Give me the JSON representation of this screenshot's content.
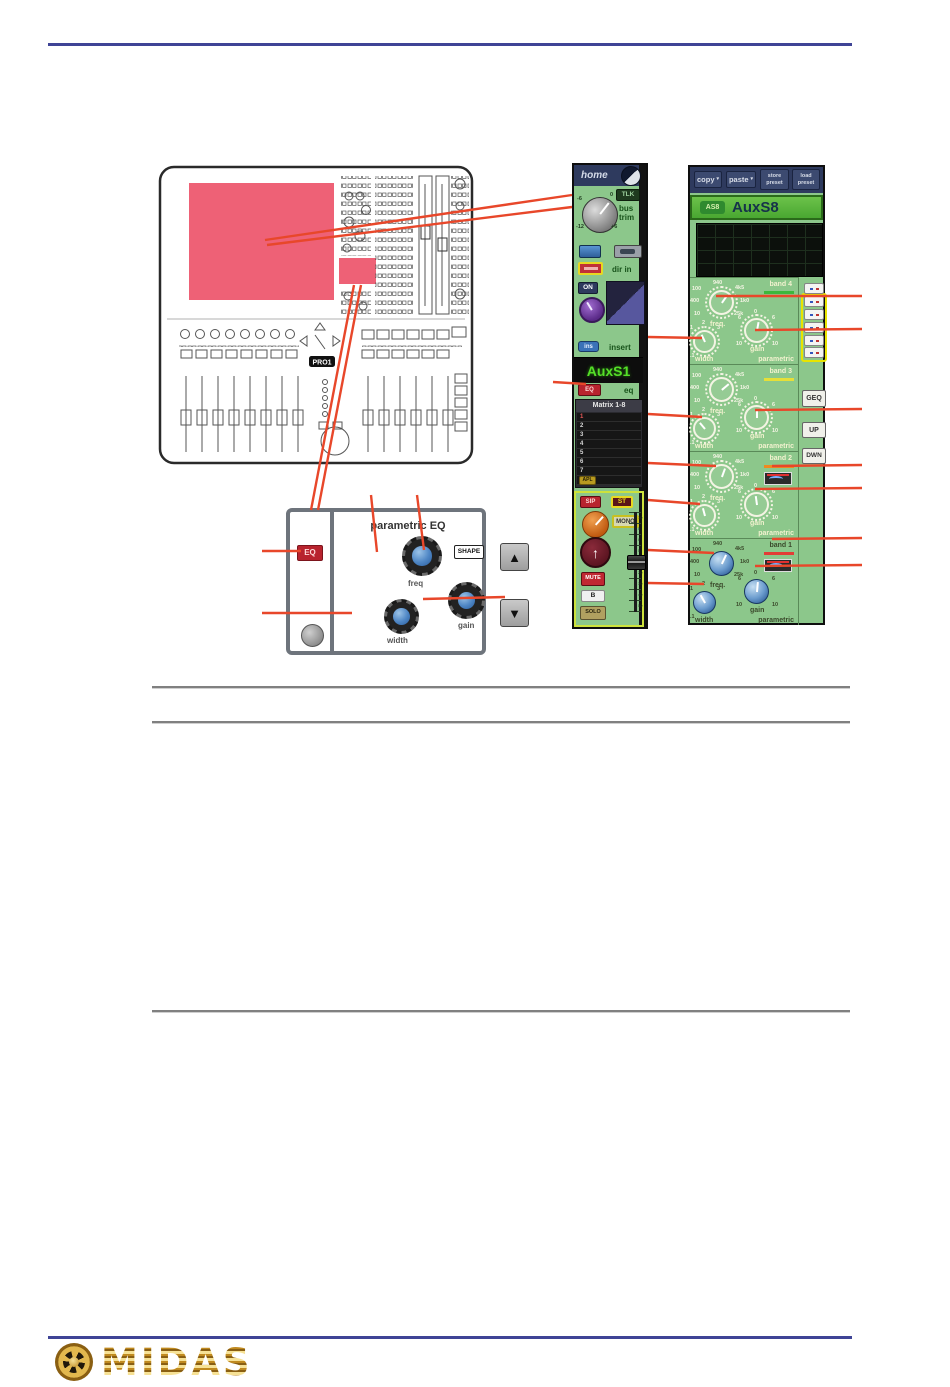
{
  "colors": {
    "accent_rule": "#3f4496",
    "callout": "#e8472a",
    "screen_highlight": "#ee6176",
    "strip_green": "#8cc78b",
    "name_text_green": "#55e028"
  },
  "console": {
    "model_badge": "PRO1"
  },
  "detail_panel": {
    "title": "parametric EQ",
    "eq_button": "EQ",
    "shape_button": "SHAPE",
    "freq_label": "freq",
    "width_label": "width",
    "gain_label": "gain",
    "up_icon": "▲",
    "down_icon": "▼"
  },
  "home_strip": {
    "header": "home",
    "tlk_button": "TLK",
    "bus_trim": {
      "line1": "bus",
      "line2": "trim",
      "tick_minus6": "-6",
      "tick_zero": "0",
      "tick_minus12": "-12",
      "tick_plus6": "+6"
    },
    "dir_in": {
      "label": "dir in"
    },
    "direct": {
      "on_button": "ON"
    },
    "insert": {
      "button": "ins",
      "label": "insert"
    },
    "name": "AuxS1",
    "eq": {
      "button": "EQ",
      "label": "eq"
    },
    "matrix": {
      "title": "Matrix 1-8",
      "rows": [
        "1",
        "2",
        "3",
        "4",
        "5",
        "6",
        "7",
        "8"
      ],
      "apl_button": "APL"
    },
    "master": {
      "sip": "SIP",
      "st": "ST",
      "mono": "MONO",
      "mute": "MUTE",
      "b": "B",
      "solo": "SOLO",
      "fader_ticks": [
        "10",
        "5",
        "0",
        "5",
        "10",
        "20",
        "30",
        "40",
        "50"
      ]
    }
  },
  "aux_strip": {
    "toolbar": {
      "copy": "copy",
      "paste": "paste",
      "store": "store preset",
      "load": "load preset",
      "dropdown_icon": "▾"
    },
    "name_badge": "AS8",
    "name": "AuxS8",
    "labels": {
      "freq": "freq.",
      "width": "width",
      "gain": "gain",
      "parametric": "parametric"
    },
    "freq_ticks": [
      "100",
      "940",
      "4k5",
      "400",
      "10",
      "1k0",
      "25k"
    ],
    "width_ticks": [
      "1",
      "2",
      "3",
      ".1"
    ],
    "gain_ticks": [
      "0",
      "6",
      "6",
      "10",
      "10"
    ],
    "bands": [
      {
        "label": "band 4",
        "underline_color": "#3cb83c"
      },
      {
        "label": "band 3",
        "underline_color": "#e6df38"
      },
      {
        "label": "band 2",
        "underline_color": "#ef8a1f"
      },
      {
        "label": "band 1",
        "underline_color": "#e33c35"
      }
    ],
    "side": {
      "geq": "GEQ",
      "up": "UP",
      "dwn": "DWN"
    }
  },
  "footer": {
    "brand": "MIDAS"
  }
}
